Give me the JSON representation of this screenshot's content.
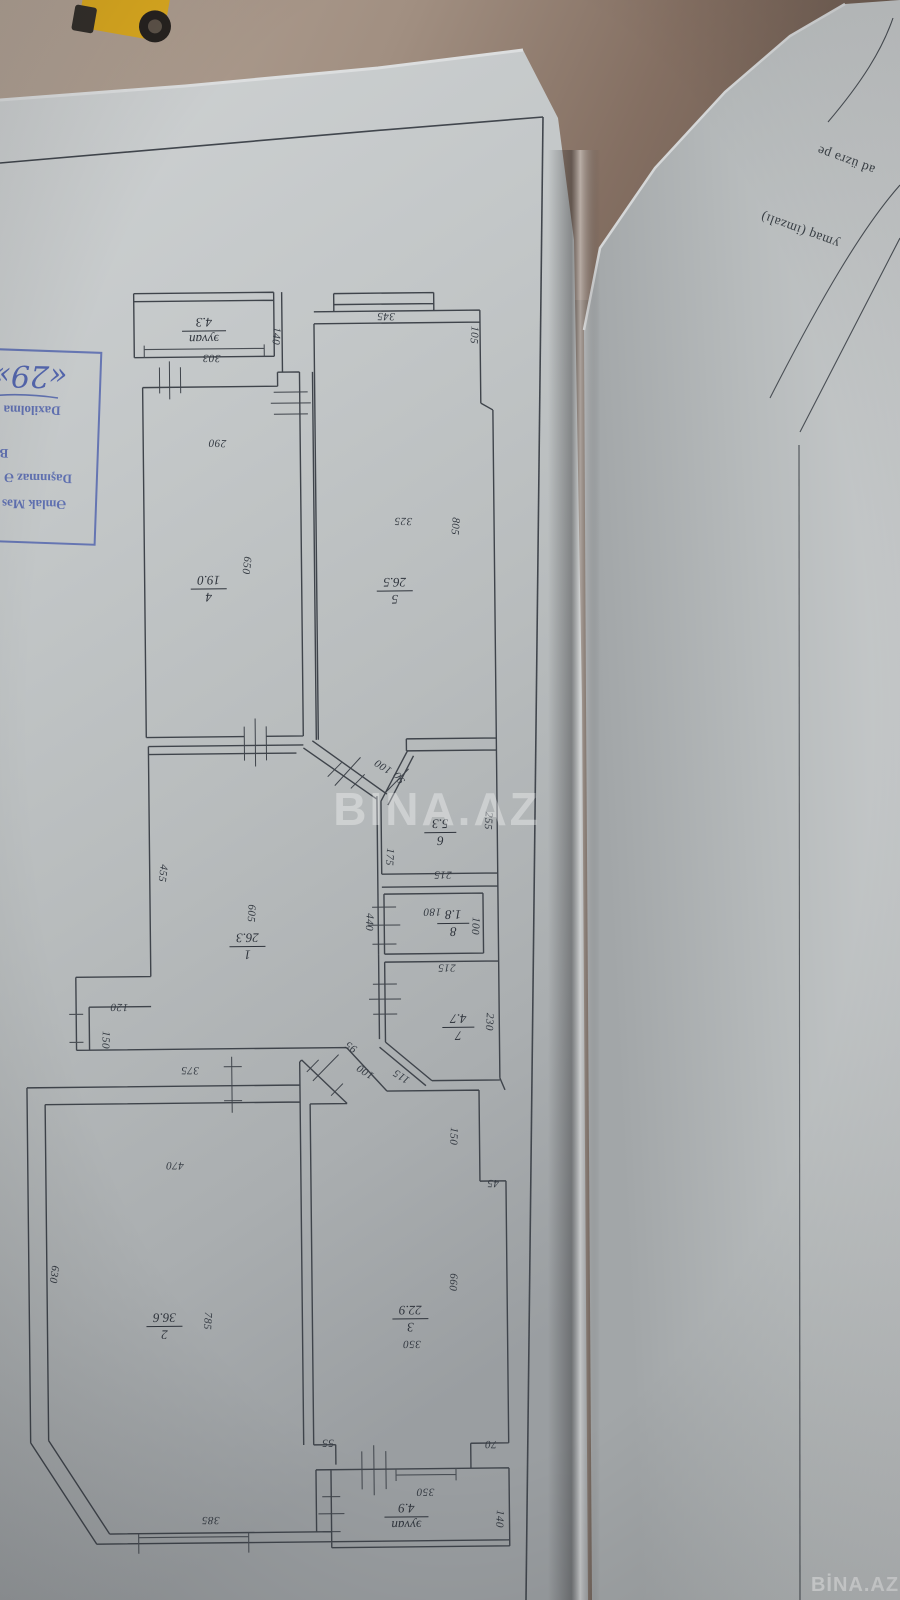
{
  "watermarks": {
    "center": "BINA.AZ",
    "corner": "BİNA.AZ"
  },
  "stamp": {
    "lines": [
      "Əmlak Məs",
      "Daşınmaz Ə",
      "B",
      "Daxilolma",
      "«29»"
    ]
  },
  "side_page": {
    "fragments": [
      "ad üzrə pe",
      "ymaq (imzalı)"
    ]
  },
  "plan": {
    "rooms": [
      {
        "num": "1",
        "area": "26.3"
      },
      {
        "num": "2",
        "area": "36.6"
      },
      {
        "num": "3",
        "area": "22.9"
      },
      {
        "num": "4",
        "area": "19.0"
      },
      {
        "num": "5",
        "area": "26.5"
      },
      {
        "num": "6",
        "area": "5.3"
      },
      {
        "num": "7",
        "area": "4.7"
      },
      {
        "num": "8",
        "area": "1.8"
      },
      {
        "num": "эyvan",
        "area": "4.3"
      },
      {
        "num": "эyvan",
        "area": "4.9"
      }
    ],
    "dims": [
      "303",
      "140",
      "290",
      "650",
      "345",
      "105",
      "325",
      "805",
      "100",
      "90",
      "255",
      "175",
      "215",
      "180",
      "100",
      "440",
      "215",
      "230",
      "95",
      "100",
      "115",
      "605",
      "455",
      "120",
      "150",
      "375",
      "470",
      "630",
      "785",
      "385",
      "150",
      "45",
      "660",
      "350",
      "55",
      "70",
      "350",
      "140"
    ]
  },
  "colors": {
    "paper_gray": "#bfc3c4",
    "plan_line": "#3f444b",
    "stamp_blue": "#5668ad",
    "floor_brown": "#8a7767",
    "toy_yellow": "#d9a820",
    "watermark_white": "#ffffff"
  }
}
